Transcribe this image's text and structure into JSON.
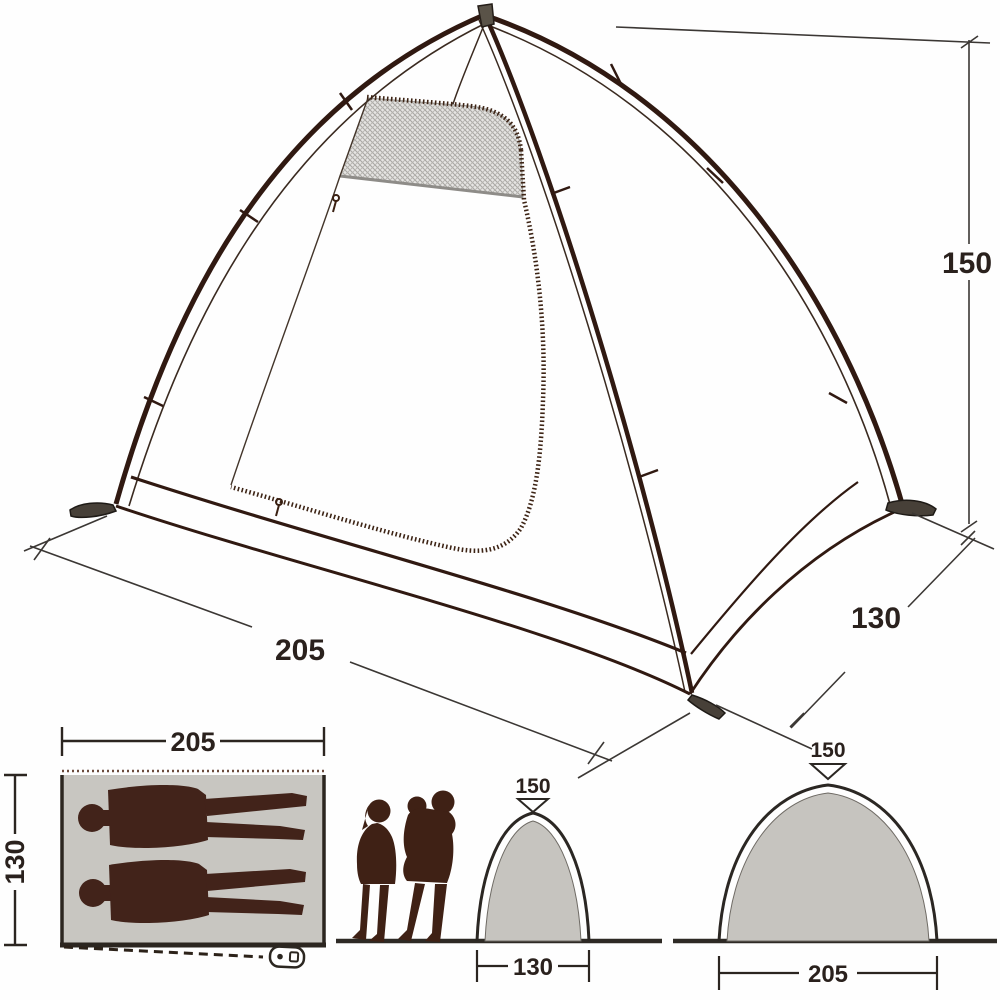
{
  "diagram_title": "tent-dimension-diagram",
  "tent_view": {
    "height_label": "150",
    "width_label": "205",
    "depth_label": "130"
  },
  "floor_plan": {
    "width_label": "205",
    "depth_label": "130"
  },
  "end_profile": {
    "height_label": "150",
    "width_label": "130"
  },
  "side_profile": {
    "height_label": "150",
    "width_label": "205"
  },
  "colors": {
    "pole_brown": "#301911",
    "annotation_dark": "#2b2520",
    "silhouette_brown": "#3f2115",
    "floor_gray": "#c8c6c1",
    "arch_gray": "#c6c4bf",
    "mesh_gray": "#e6e5e3",
    "background": "#fefefe"
  },
  "icons": {
    "peg": "tent-peg-icon",
    "zipper_pull": "zipper-pull-icon",
    "height_pointer": "triangle-down-icon",
    "figures": [
      "lying-person-silhouette",
      "standing-woman-silhouette",
      "adult-with-child-silhouette"
    ]
  }
}
